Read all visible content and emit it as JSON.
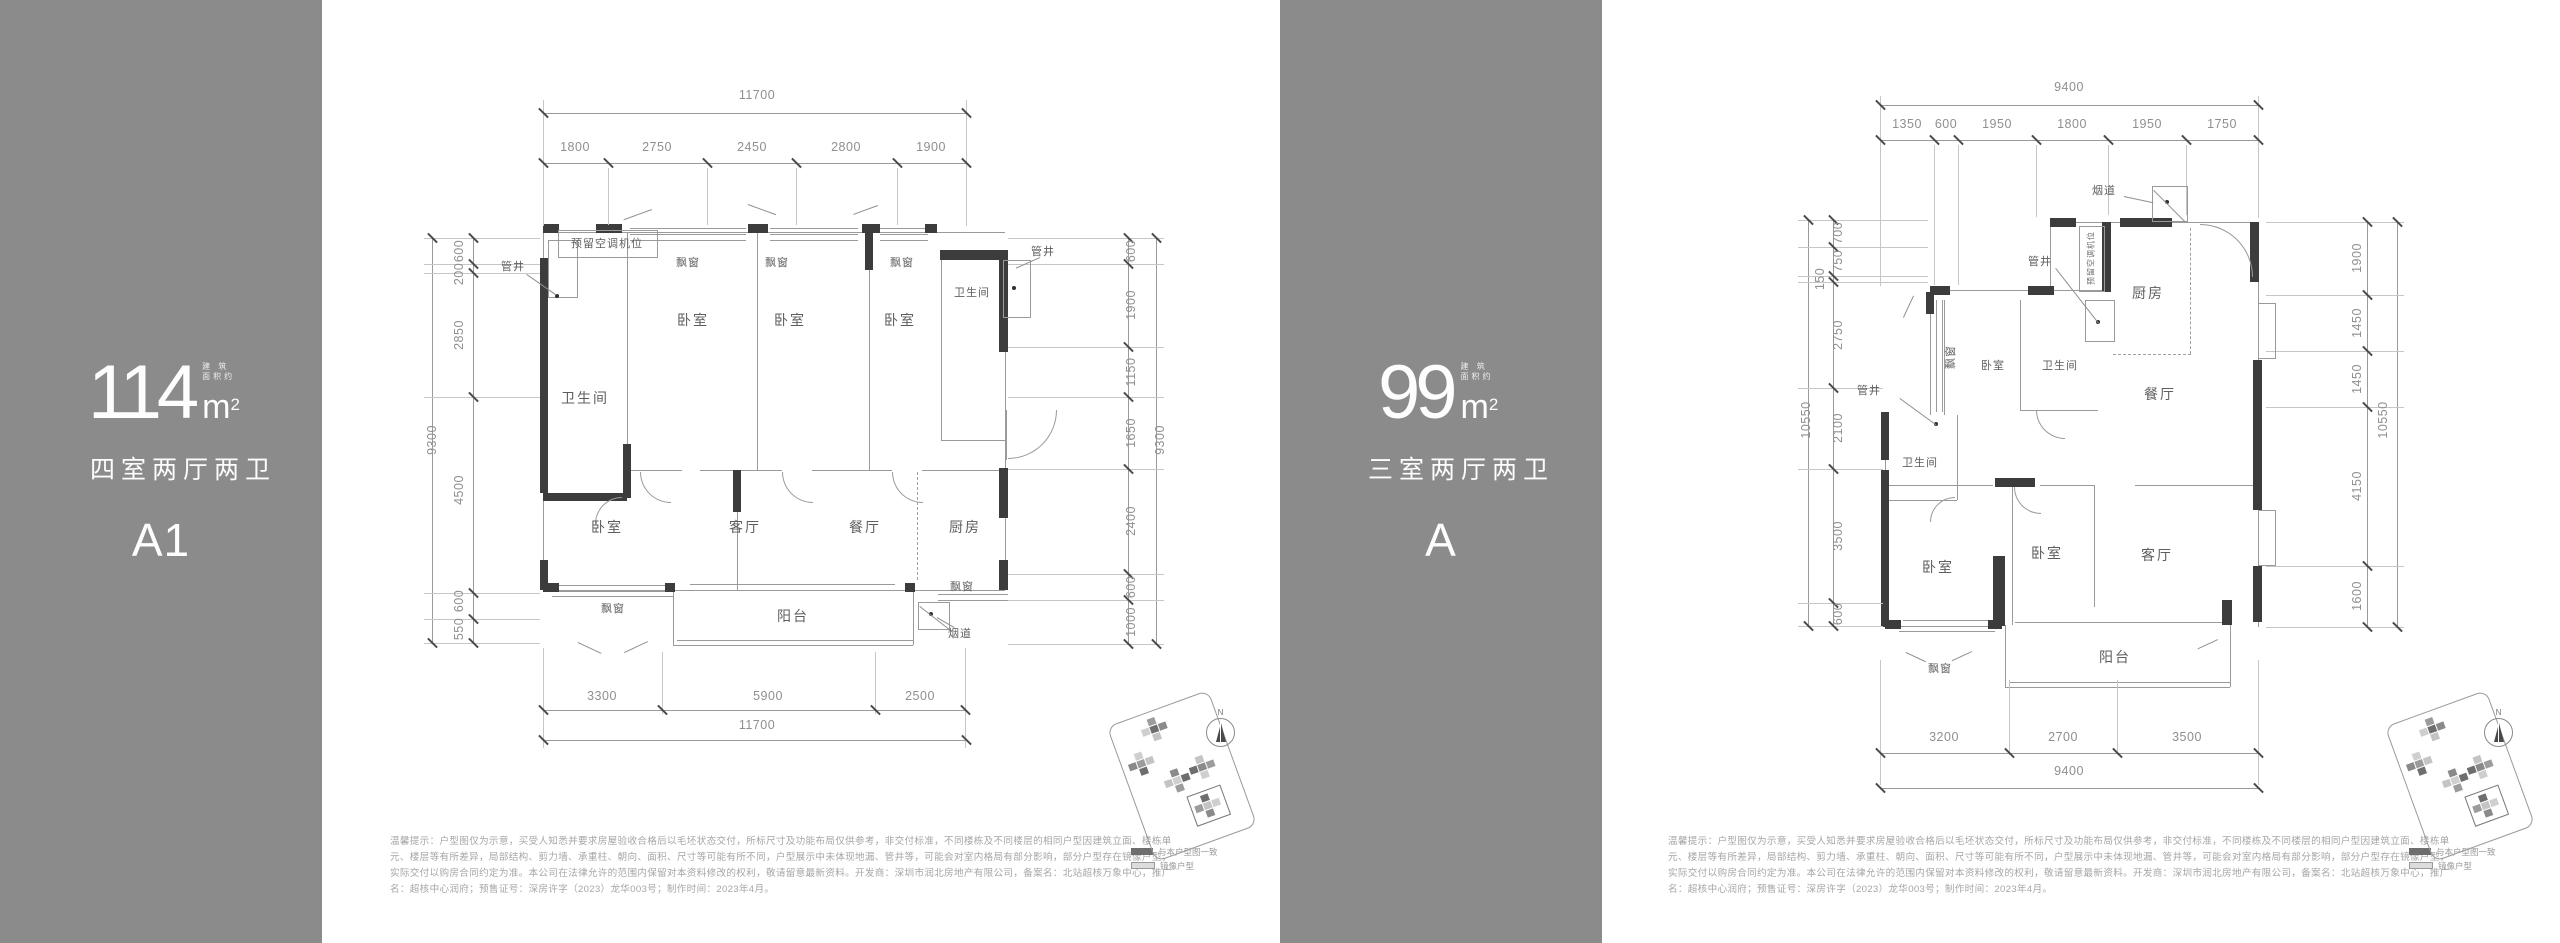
{
  "panels": {
    "p1": {
      "area": "114",
      "unit_m": "m",
      "unit_sup": "2",
      "note1": "建 筑",
      "note2": "面积约",
      "layout": "四室两厅两卫",
      "code": "A1"
    },
    "p2": {
      "area": "99",
      "unit_m": "m",
      "unit_sup": "2",
      "note1": "建 筑",
      "note2": "面积约",
      "layout": "三室两厅两卫",
      "code": "A"
    }
  },
  "plan1": {
    "top_total": "11700",
    "top_segs": [
      "1800",
      "2750",
      "2450",
      "2800",
      "1900"
    ],
    "left_total": "9300",
    "left_segs": [
      "600",
      "200",
      "2850",
      "4500",
      "600",
      "550"
    ],
    "right_total": "9300",
    "right_segs": [
      "600",
      "1900",
      "1150",
      "1650",
      "2400",
      "600",
      "1000"
    ],
    "bottom_total": "11700",
    "bottom_segs": [
      "3300",
      "5900",
      "2500"
    ],
    "rooms": {
      "ac": "预留空调机位",
      "shaft": "管井",
      "bay": "飘窗",
      "bath": "卫生间",
      "bed": "卧室",
      "living": "客厅",
      "dining": "餐厅",
      "kitchen": "厨房",
      "balcony": "阳台",
      "flue": "烟道"
    }
  },
  "plan2": {
    "top_total": "9400",
    "top_segs": [
      "1350",
      "600",
      "1950",
      "1800",
      "1950",
      "1750"
    ],
    "left_total": "10550",
    "left_segs": [
      "700",
      "750",
      "150",
      "2750",
      "2100",
      "3500",
      "600"
    ],
    "right_total": "10550",
    "right_segs": [
      "1900",
      "1450",
      "1450",
      "4150",
      "1600"
    ],
    "bottom_total": "9400",
    "bottom_segs": [
      "3200",
      "2700",
      "3500"
    ],
    "rooms": {
      "ac": "预留空调机位",
      "shaft": "管井",
      "bay": "飘窗",
      "bath": "卫生间",
      "bed": "卧室",
      "living": "客厅",
      "dining": "餐厅",
      "kitchen": "厨房",
      "balcony": "阳台",
      "flue": "烟道"
    }
  },
  "disclaimer": {
    "l1": "温馨提示：户型图仅为示意，买受人知悉并要求房屋验收合格后以毛坯状态交付，所标尺寸及功能布局仅供参考，非交付标准，不同楼栋及不同楼层的相同户型因建筑立面、楼栋单",
    "l2": "元、楼层等有所差异，局部结构、剪力墙、承重柱、朝向、面积、尺寸等可能有所不同，户型展示中未体现地漏、管井等，可能会对室内格局有部分影响，部分户型存在镜像户型，",
    "l3": "实际交付以购房合同约定为准。本公司在法律允许的范围内保留对本资料修改的权利，敬请留意最新资料。开发商：深圳市润北房地产有限公司，备案名：北站超核万象中心，推广",
    "l4": "名：超核中心润府；预售证号：深房许字（2023）龙华003号；制作时间：2023年4月。"
  },
  "legend": {
    "match": "与本户型图一致",
    "mirror": "镜像户型"
  },
  "compass_n": "N",
  "colors": {
    "sidebar": "#8b8b8b",
    "wall": "#3c3c3c",
    "line": "#9a9a9a",
    "dim_text": "#8f8f8f",
    "room_text": "#5e5e5e",
    "disclaimer_text": "#a6a6a6"
  }
}
